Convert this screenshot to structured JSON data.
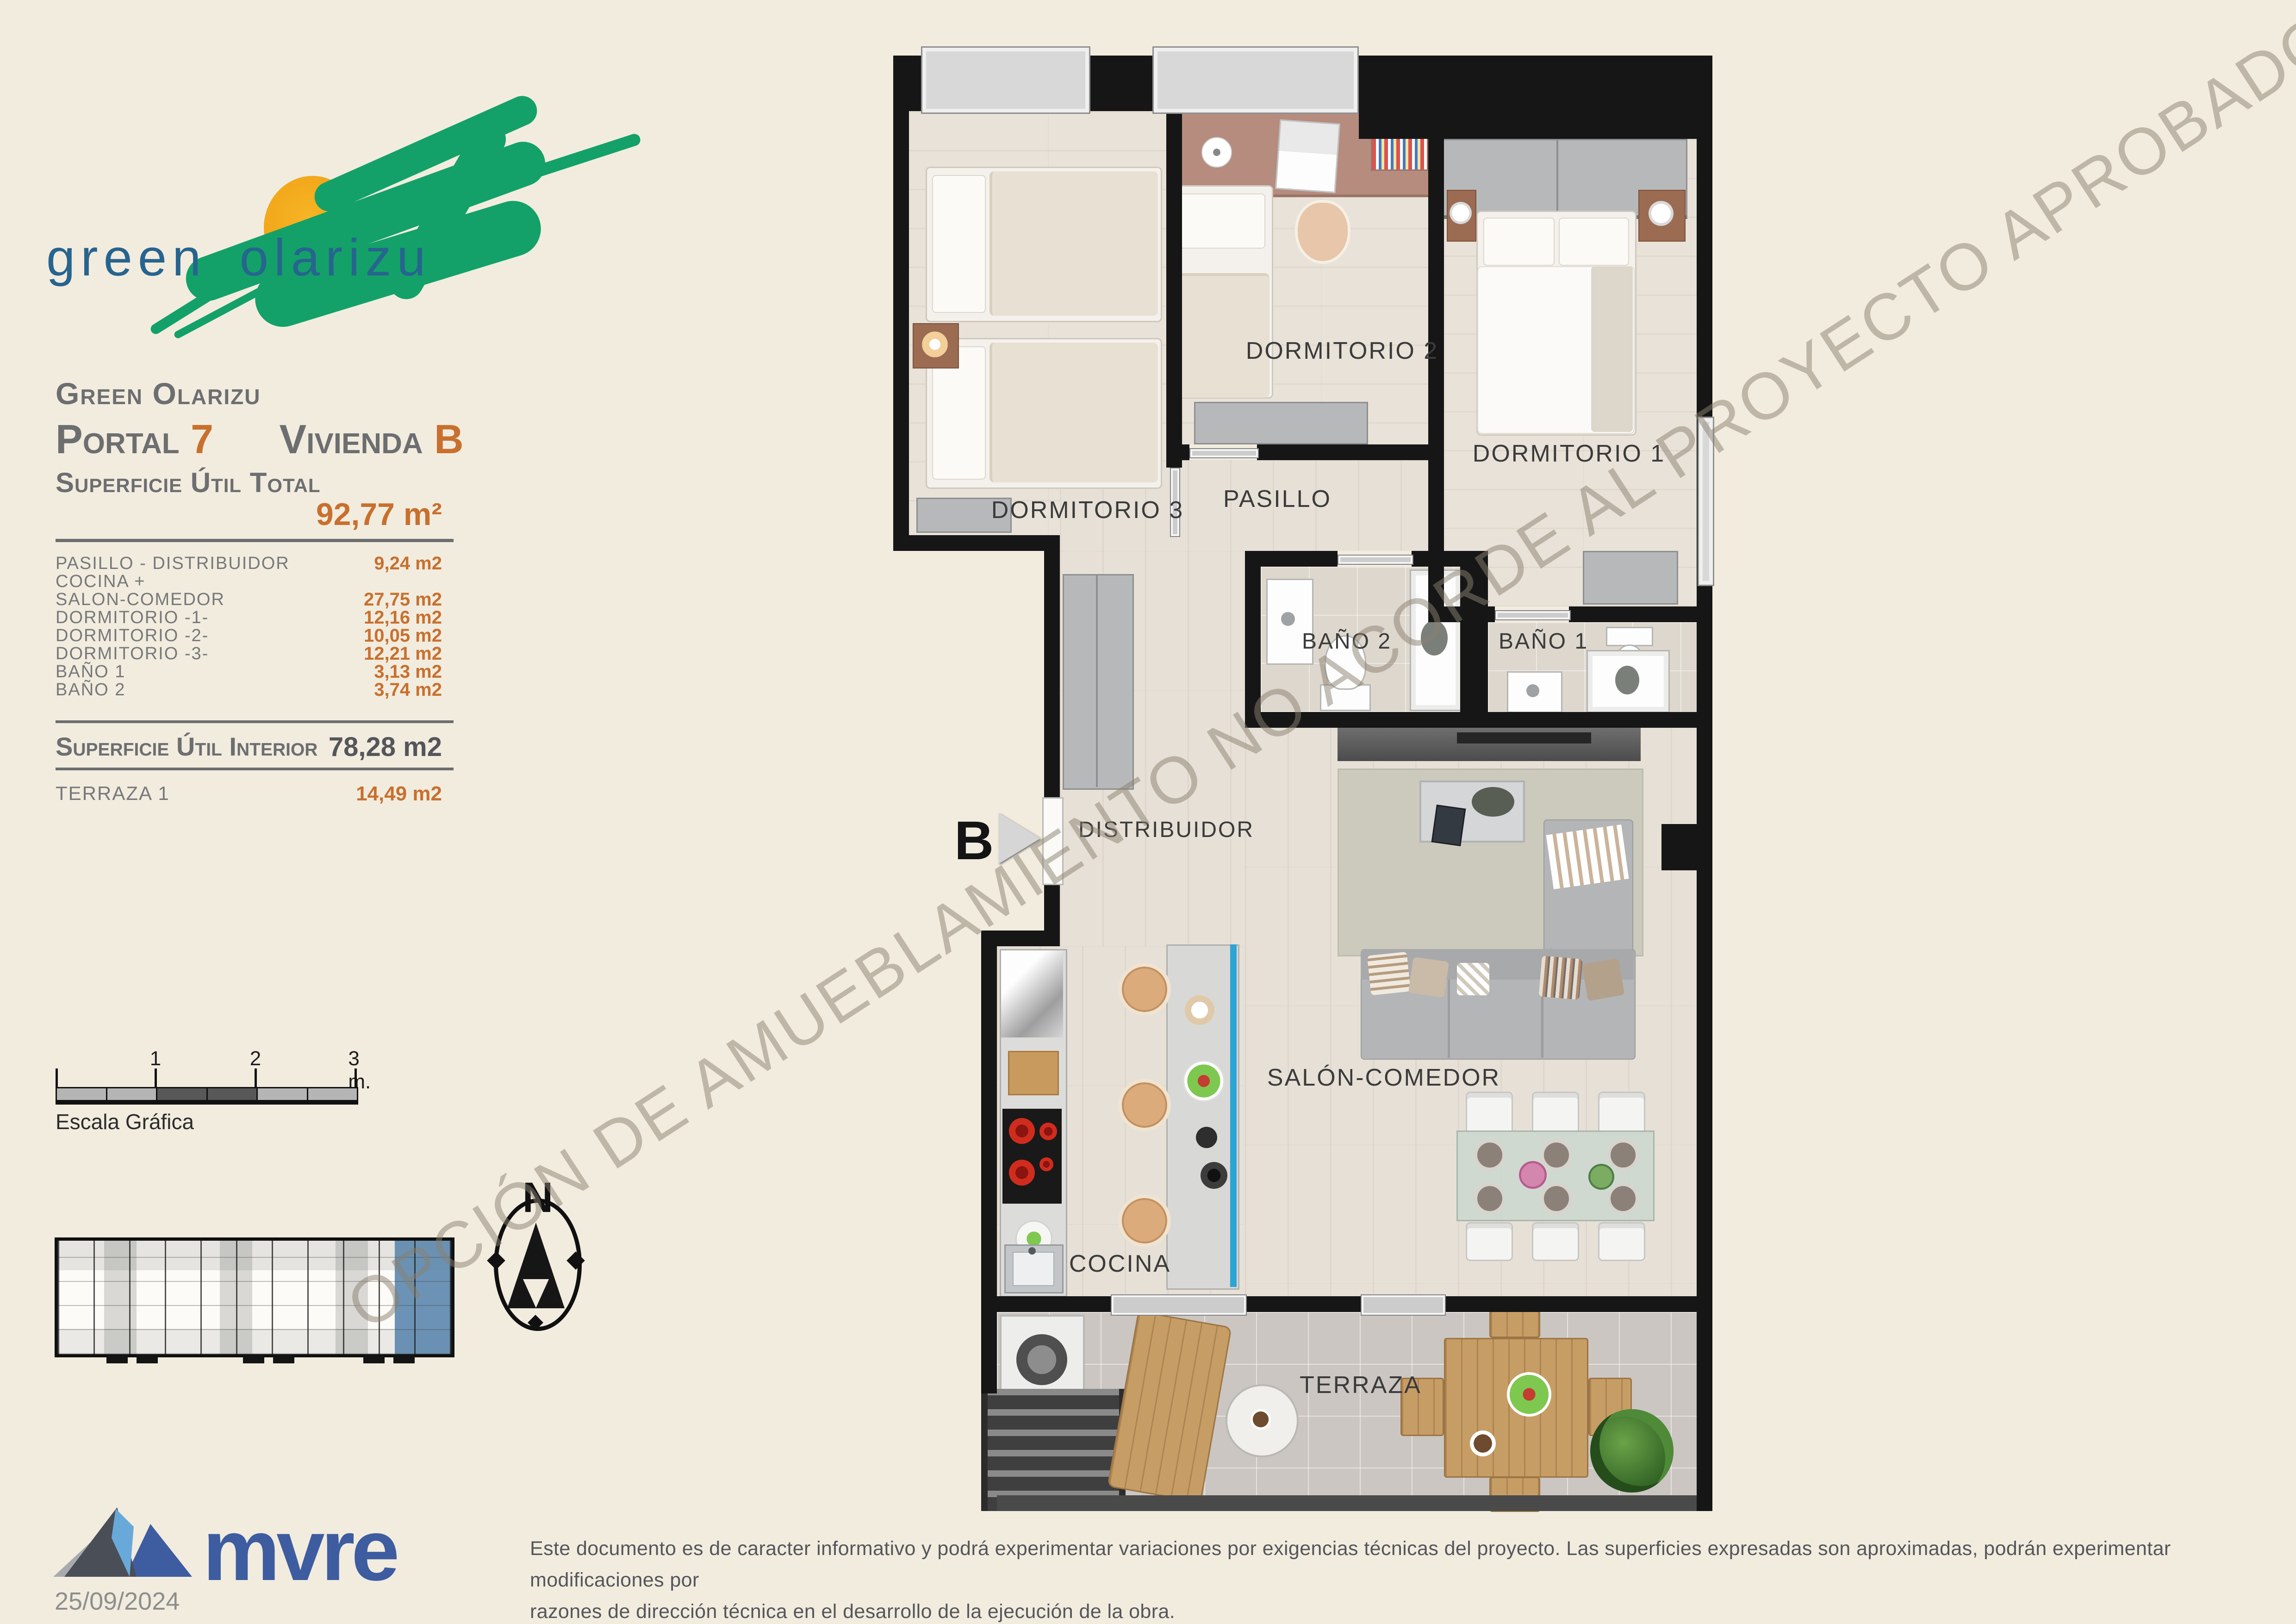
{
  "logo": {
    "wordmark": "green olarizu"
  },
  "header": {
    "project": "Green Olarizu",
    "portal_label": "Portal",
    "portal_number": "7",
    "vivienda_label": "Vivienda",
    "vivienda_letter": "B"
  },
  "surface": {
    "total_label": "Superficie Útil Total",
    "total_value": "92,77 m²",
    "rows": [
      {
        "label": "PASILLO - DISTRIBUIDOR",
        "value": "9,24 m2"
      },
      {
        "label": "COCINA +",
        "value": ""
      },
      {
        "label": "SALON-COMEDOR",
        "value": "27,75 m2"
      },
      {
        "label": "DORMITORIO -1-",
        "value": "12,16 m2"
      },
      {
        "label": "DORMITORIO -2-",
        "value": "10,05 m2"
      },
      {
        "label": "DORMITORIO -3-",
        "value": "12,21 m2"
      },
      {
        "label": "BAÑO 1",
        "value": "3,13 m2"
      },
      {
        "label": "BAÑO 2",
        "value": "3,74 m2"
      }
    ],
    "interior_label": "Superficie Útil Interior",
    "interior_value": "78,28 m2",
    "terrace_label": "TERRAZA 1",
    "terrace_value": "14,49 m2"
  },
  "scalebar": {
    "label": "Escala Gráfica",
    "ticks": [
      "1",
      "2",
      "3 m."
    ]
  },
  "compass": {
    "north": "N"
  },
  "plan": {
    "watermark": "OPCIÓN DE AMUEBLAMIENTO NO ACORDE AL PROYECTO APROBADO",
    "entrance_marker": "B",
    "rooms": {
      "dorm1": "DORMITORIO 1",
      "dorm2": "DORMITORIO 2",
      "dorm3": "DORMITORIO 3",
      "pasillo": "PASILLO",
      "bano1": "BAÑO 1",
      "bano2": "BAÑO 2",
      "distribuidor": "DISTRIBUIDOR",
      "salon": "SALÓN-COMEDOR",
      "cocina": "COCINA",
      "terraza": "TERRAZA"
    }
  },
  "footer": {
    "brand": "mvre",
    "date": "25/09/2024",
    "disclaimer_line1": "Este documento es de caracter informativo y podrá experimentar variaciones por exigencias técnicas del proyecto. Las superficies expresadas son aproximadas, podrán experimentar modificaciones por",
    "disclaimer_line2": "razones de dirección técnica en el desarrollo de la ejecución de la obra."
  },
  "colors": {
    "accent_orange": "#c8702e",
    "text_gray": "#6d6e70",
    "logo_green": "#13a169",
    "logo_sun": "#f5a91c",
    "logo_text_blue": "#27648e",
    "brand_blue": "#3e5ca0",
    "keyplan_highlight": "#5c87ad"
  }
}
